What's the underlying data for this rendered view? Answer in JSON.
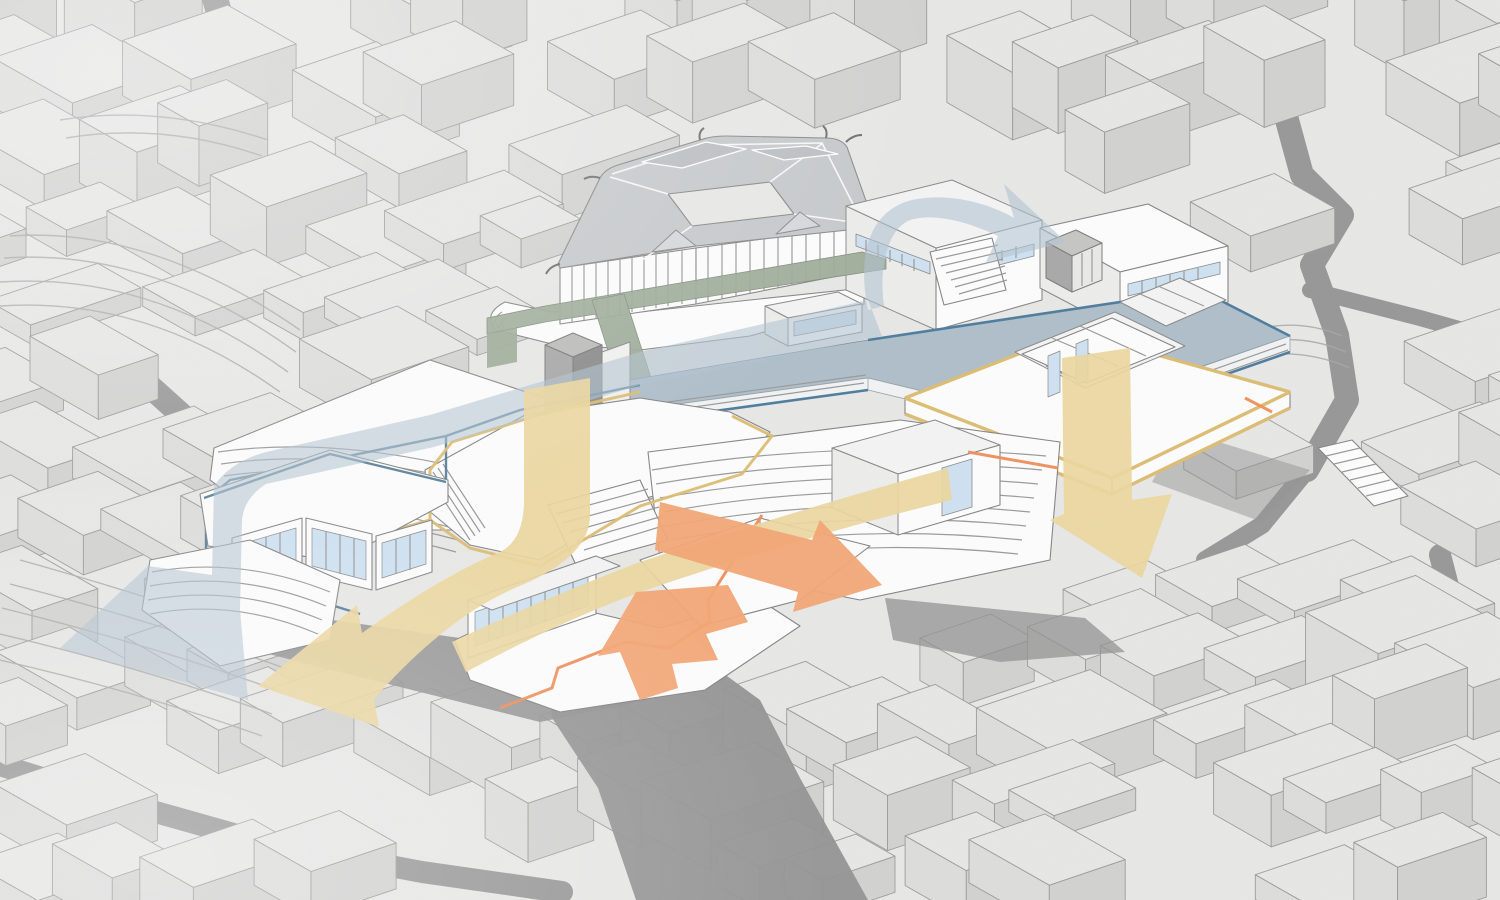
{
  "diagram": {
    "kind": "axonometric architectural circulation diagram",
    "subject": "hillside cultural complex with traditional courtyard-roof hall set in dense gray city massing",
    "elements": [
      {
        "name": "city-context-massing",
        "color_ref": "block_top"
      },
      {
        "name": "street-canyons",
        "color_ref": "street"
      },
      {
        "name": "courtyard-hall-roofs",
        "color_ref": "roof_gray"
      },
      {
        "name": "roof-deck",
        "color_ref": "deck_blue"
      },
      {
        "name": "green-walkway-and-escalator",
        "color_ref": "walkway_green"
      },
      {
        "name": "mid-level-floor-plate-yellow-edge",
        "color_ref": "path_yellow_line"
      },
      {
        "name": "lower-plaza-orange-edge",
        "color_ref": "path_orange_line"
      },
      {
        "name": "concrete-core",
        "color_ref": "core_gray"
      },
      {
        "name": "amphitheater-steps",
        "color_ref": "building_white"
      }
    ],
    "arrows": [
      {
        "name": "deck-entry-arrow",
        "color_ref": "circulation_blue",
        "points": "onto roof deck, upper right"
      },
      {
        "name": "blue-descent-arrow",
        "color_ref": "circulation_blue",
        "points": "down terraces to lower left exit"
      },
      {
        "name": "yellow-core-descent-arrow",
        "color_ref": "circulation_yellow",
        "points": "down through atrium to lower-left exit"
      },
      {
        "name": "yellow-right-descent-arrow",
        "color_ref": "circulation_yellow",
        "points": "down to street on right"
      },
      {
        "name": "orange-plaza-arrow-right",
        "color_ref": "circulation_orange",
        "points": "out of plaza to lower right"
      },
      {
        "name": "orange-plaza-arrow-down",
        "color_ref": "circulation_orange",
        "points": "down from plaza to ravine"
      }
    ]
  },
  "colors": {
    "background": "#e8e8e7",
    "block_top": "#e7e7e6",
    "block_front": "#dddddc",
    "block_side": "#d2d2d1",
    "block_line": "#9c9c9c",
    "street": "#8f8f8f",
    "shadow": "#939393",
    "building_white": "#fdfdfd",
    "building_line": "#808080",
    "roof_gray": "#c7cacc",
    "roof_gray_dark": "#bcc0c3",
    "glazing": "#cfe2f2",
    "deck_blue": "#afbfca",
    "deck_edge_blue": "#4f7d9e",
    "path_blue_line": "#4a7591",
    "circulation_blue": "#b2c2d1",
    "circulation_yellow": "#ecd7a0",
    "path_yellow_line": "#dcbd74",
    "circulation_orange": "#f3a775",
    "path_orange_line": "#ef8d58",
    "walkway_green": "#9fac99",
    "walkway_green_dark": "#70806d",
    "core_gray": "#a9a9a9",
    "core_gray_dark": "#8d8d8d"
  }
}
